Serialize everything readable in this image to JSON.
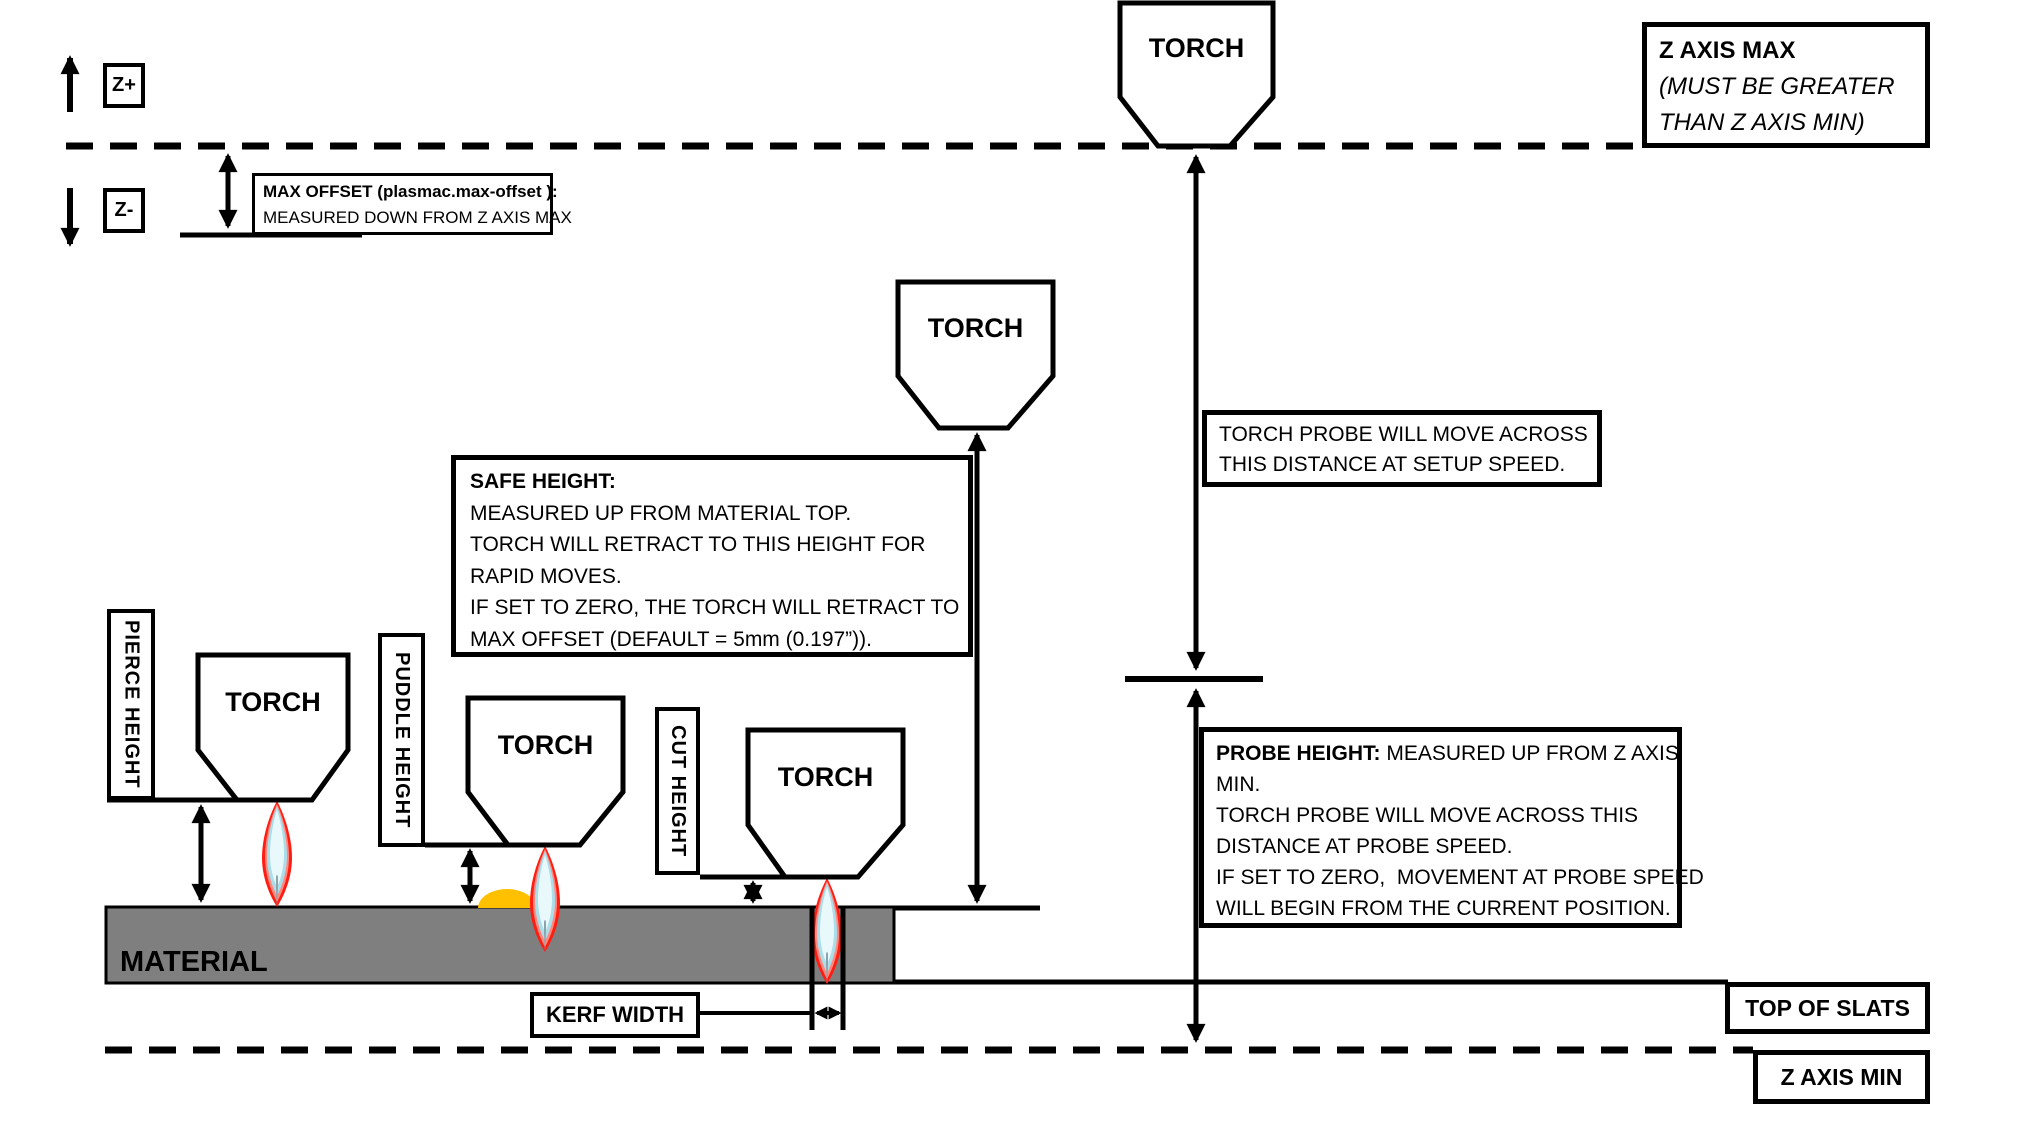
{
  "colors": {
    "material": "#7f7f7f",
    "puddle": "#ffc000",
    "flame_outer": "#ff1d12",
    "flame_mid": "#ff8a80",
    "flame_inner": "#aadeea",
    "flame_core": "#e9f8fb",
    "flame_tail": "#8ba1a9",
    "line": "#000000"
  },
  "axis": {
    "z_plus": "Z+",
    "z_minus": "Z-"
  },
  "max_offset": {
    "title": "MAX OFFSET (plasmac.max-offset ):",
    "line2": "MEASURED DOWN FROM Z AXIS MAX"
  },
  "z_axis_max": {
    "title": "Z AXIS MAX",
    "note_line1": "(MUST BE GREATER",
    "note_line2": "THAN Z AXIS MIN)"
  },
  "torch_label": "TORCH",
  "setup_note": {
    "line1": "TORCH PROBE WILL MOVE ACROSS",
    "line2": "THIS DISTANCE AT SETUP SPEED."
  },
  "safe_height": {
    "title": "SAFE HEIGHT:",
    "lines": [
      "MEASURED UP FROM MATERIAL TOP.",
      "TORCH WILL RETRACT TO THIS HEIGHT FOR",
      "RAPID MOVES.",
      "IF SET TO ZERO, THE TORCH WILL RETRACT TO",
      "MAX OFFSET (DEFAULT = 5mm (0.197”))."
    ]
  },
  "probe_height": {
    "title": "PROBE HEIGHT:",
    "after_title": " MEASURED UP FROM Z AXIS",
    "lines": [
      "MIN.",
      "TORCH PROBE WILL MOVE ACROSS THIS",
      "DISTANCE AT PROBE SPEED.",
      "IF SET TO ZERO,  MOVEMENT AT PROBE SPEED",
      "WILL BEGIN FROM THE CURRENT POSITION."
    ]
  },
  "vertical_labels": {
    "pierce": "PIERCE HEIGHT",
    "puddle": "PUDDLE HEIGHT",
    "cut": "CUT HEIGHT"
  },
  "material_label": "MATERIAL",
  "kerf_width_label": "KERF WIDTH",
  "top_of_slats_label": "TOP OF SLATS",
  "z_axis_min_label": "Z AXIS MIN"
}
